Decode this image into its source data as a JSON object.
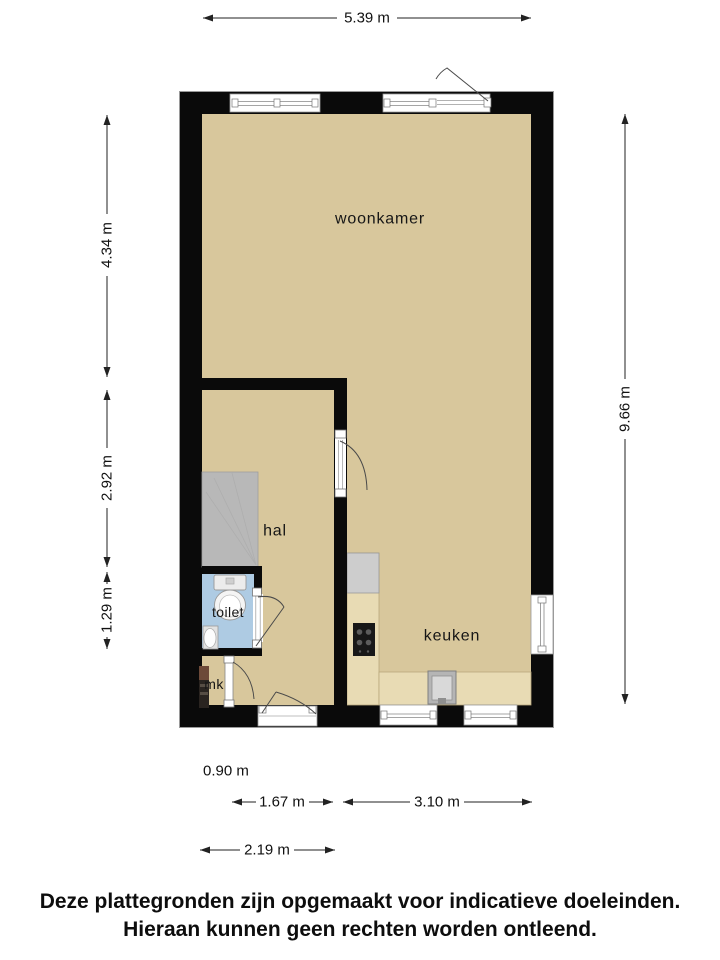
{
  "rooms": {
    "woonkamer": "woonkamer",
    "hal": "hal",
    "toilet": "toilet",
    "keuken": "keuken",
    "mk": "mk"
  },
  "dimensions": {
    "width_top": "5.39 m",
    "left_upper": "4.34 m",
    "left_middle": "2.92 m",
    "left_lower": "1.29 m",
    "height_right": "9.66 m",
    "bottom_mk": "0.90 m",
    "bottom_hal": "1.67 m",
    "bottom_keuken": "3.10 m",
    "bottom_hal_total": "2.19 m"
  },
  "disclaimer": {
    "line1": "Deze plattegronden zijn opgemaakt voor indicatieve doeleinden.",
    "line2": "Hieraan kunnen geen rechten worden ontleend."
  },
  "colors": {
    "wall": "#0a0a0a",
    "floor": "#d8c79c",
    "toilet_floor": "#aecbe3",
    "counter": "#e8dbb4",
    "stairs": "#b8b8b8",
    "appliance": "#cdcdcd"
  }
}
